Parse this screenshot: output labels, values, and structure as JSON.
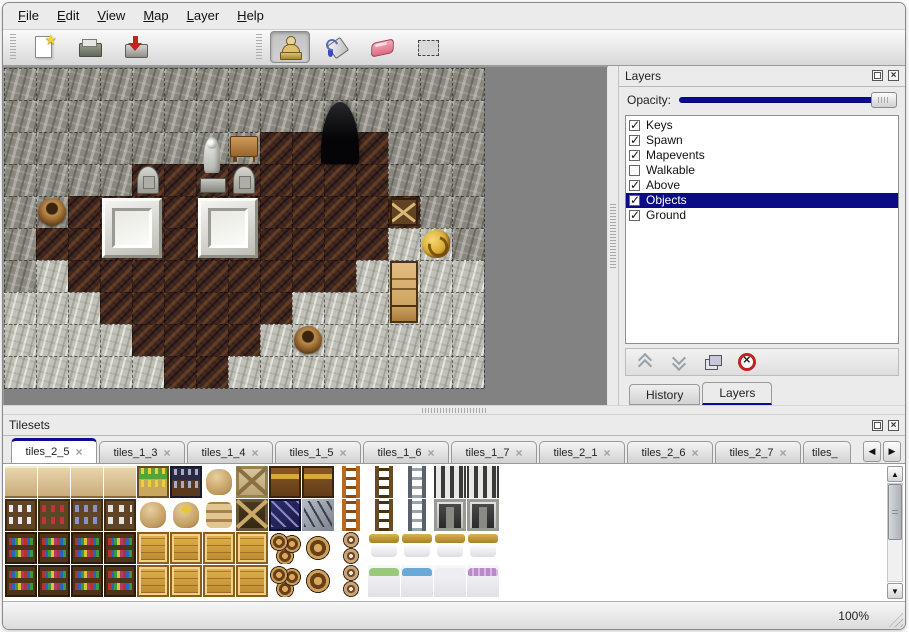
{
  "window": {
    "background": "#ebebeb",
    "border_color": "#8a8a8a"
  },
  "colors": {
    "accent_navy": "#0c0c8e",
    "selection_bg": "#0b0b86",
    "selection_text": "#ffffff",
    "map_backdrop": "#828282",
    "rock_wall": "#8a887e",
    "wood_floor": "#42291c",
    "stone_floor": "#c2c1b8"
  },
  "menu_bar": {
    "items": [
      {
        "label": "File"
      },
      {
        "label": "Edit"
      },
      {
        "label": "View"
      },
      {
        "label": "Map"
      },
      {
        "label": "Layer"
      },
      {
        "label": "Help"
      }
    ]
  },
  "toolbar": {
    "groups": [
      {
        "buttons": [
          {
            "icon": "new-file",
            "active": false
          },
          {
            "icon": "open-file",
            "active": false
          },
          {
            "icon": "save-file",
            "active": false
          },
          {
            "icon": "undo",
            "active": false
          },
          {
            "icon": "redo",
            "active": false
          }
        ]
      },
      {
        "buttons": [
          {
            "icon": "stamp-brush",
            "active": true
          },
          {
            "icon": "bucket-fill",
            "active": false
          },
          {
            "icon": "eraser",
            "active": false
          },
          {
            "icon": "rect-select",
            "active": false
          }
        ]
      }
    ]
  },
  "map_view": {
    "tile_size": 32,
    "legend": {
      "W": "rock-wall",
      "F": "wood-floor",
      "S": "stone-floor",
      "C": "cave-opening"
    },
    "grid": [
      "WWWWWWWWWWWWWWW",
      "WWWWWWWWWWCWWWW",
      "WWWWWWWWFFCFWWW",
      "WWWWFFFFFFFFWWW",
      "WWFFFFFFFFFFFWW",
      "WFFFFFFFFFFFSSW",
      "WSFFFFFFFFFSSSS",
      "SSSFFFFFFSSSSSS",
      "SSSSFFFFSSSSSSS",
      "SSSSSFFSSSSSSSS"
    ],
    "objects": [
      {
        "type": "cave-entrance",
        "col": 10,
        "row": 1,
        "w": 1,
        "h": 2
      },
      {
        "type": "statue",
        "col": 6,
        "row": 2,
        "w": 1,
        "h": 2
      },
      {
        "type": "table",
        "col": 7,
        "row": 2,
        "w": 1,
        "h": 1
      },
      {
        "type": "gravestone",
        "col": 4,
        "row": 3,
        "w": 1,
        "h": 1
      },
      {
        "type": "gravestone",
        "col": 7,
        "row": 3,
        "w": 1,
        "h": 1
      },
      {
        "type": "tomb-slab",
        "col": 3,
        "row": 4,
        "w": 2,
        "h": 2
      },
      {
        "type": "tomb-slab",
        "col": 6,
        "row": 4,
        "w": 2,
        "h": 2
      },
      {
        "type": "basket",
        "col": 1,
        "row": 4,
        "w": 1,
        "h": 1
      },
      {
        "type": "broken-crate",
        "col": 12,
        "row": 4,
        "w": 1,
        "h": 1
      },
      {
        "type": "gold-ornament",
        "col": 13,
        "row": 5,
        "w": 1,
        "h": 1
      },
      {
        "type": "cabinet",
        "col": 12,
        "row": 6,
        "w": 1,
        "h": 2
      },
      {
        "type": "basket",
        "col": 9,
        "row": 8,
        "w": 1,
        "h": 1
      }
    ]
  },
  "layers_panel": {
    "title": "Layers",
    "float_icon": "float-panel-icon",
    "close_icon": "close-panel-icon",
    "opacity_label": "Opacity:",
    "opacity_percent": 100,
    "layers": [
      {
        "name": "Keys",
        "visible": true,
        "selected": false
      },
      {
        "name": "Spawn",
        "visible": true,
        "selected": false
      },
      {
        "name": "Mapevents",
        "visible": true,
        "selected": false
      },
      {
        "name": "Walkable",
        "visible": false,
        "selected": false
      },
      {
        "name": "Above",
        "visible": true,
        "selected": false
      },
      {
        "name": "Objects",
        "visible": true,
        "selected": true
      },
      {
        "name": "Ground",
        "visible": true,
        "selected": false
      }
    ],
    "buttons": [
      {
        "icon": "raise-layer"
      },
      {
        "icon": "lower-layer"
      },
      {
        "icon": "duplicate-layer"
      },
      {
        "icon": "delete-layer"
      }
    ],
    "tabs": [
      {
        "label": "History",
        "active": false
      },
      {
        "label": "Layers",
        "active": true
      }
    ]
  },
  "tilesets_panel": {
    "title": "Tilesets",
    "float_icon": "float-panel-icon",
    "close_icon": "close-panel-icon",
    "scroll_left_icon": "scroll-tabs-left",
    "scroll_right_icon": "scroll-tabs-right",
    "tabs": [
      {
        "label": "tiles_2_5",
        "active": true,
        "truncated": false
      },
      {
        "label": "tiles_1_3",
        "active": false,
        "truncated": false
      },
      {
        "label": "tiles_1_4",
        "active": false,
        "truncated": false
      },
      {
        "label": "tiles_1_5",
        "active": false,
        "truncated": false
      },
      {
        "label": "tiles_1_6",
        "active": false,
        "truncated": false
      },
      {
        "label": "tiles_1_7",
        "active": false,
        "truncated": false
      },
      {
        "label": "tiles_2_1",
        "active": false,
        "truncated": false
      },
      {
        "label": "tiles_2_6",
        "active": false,
        "truncated": false
      },
      {
        "label": "tiles_2_7",
        "active": false,
        "truncated": false
      },
      {
        "label": "tiles_",
        "active": false,
        "truncated": true
      }
    ],
    "tile_size": 33,
    "legend": {
      "st": "shelf-top",
      "sd": "shelf-dishes",
      "sr": "shelf-red-bottles",
      "sb": "shelf-blue-jars",
      "sj": "shelf-white-jars",
      "bk": "bookshelf",
      "pl": "planter-box",
      "fi": "fish-crate",
      "sa": "sack",
      "gs": "open-gold-sack",
      "sp": "sack-pile",
      "cr": "gold-crate",
      "cx": "crate-crossed-light",
      "cd": "crate-crossed-dark",
      "ch": "wooden-chest",
      "bc": "broken-blue-crate",
      "sv": "metal-scrap",
      "lo": "ladder-orange",
      "lb": "ladder-brown",
      "lg": "ladder-gray",
      "ar": "stone-arch",
      "dr": "stone-doorway",
      "bl": "barrel-cluster",
      "br": "barrel",
      "po": "clay-pots",
      "bh": "bed-headboard",
      "bg": "bed-green-blanket",
      "bu": "bed-blue-blanket",
      "bw": "bed-white",
      "bp": "bed-purple-blanket",
      "__": "empty"
    },
    "grid": [
      [
        "st",
        "st",
        "st",
        "st",
        "pl",
        "fi",
        "sa",
        "cx",
        "ch",
        "ch",
        "lo",
        "lb",
        "lg",
        "ar",
        "ar",
        "__"
      ],
      [
        "sd",
        "sr",
        "sb",
        "sj",
        "sa",
        "gs",
        "sp",
        "cd",
        "bc",
        "sv",
        "lo",
        "lb",
        "lg",
        "dr",
        "dr",
        "__"
      ],
      [
        "bk",
        "bk",
        "bk",
        "bk",
        "cr",
        "cr",
        "cr",
        "cr",
        "bl",
        "br",
        "po",
        "bh",
        "bh",
        "bh",
        "bh",
        "__"
      ],
      [
        "bk",
        "bk",
        "bk",
        "bk",
        "cr",
        "cr",
        "cr",
        "cr",
        "bl",
        "br",
        "po",
        "bg",
        "bu",
        "bw",
        "bp",
        "__"
      ]
    ]
  },
  "status_bar": {
    "zoom_level": "100%"
  }
}
